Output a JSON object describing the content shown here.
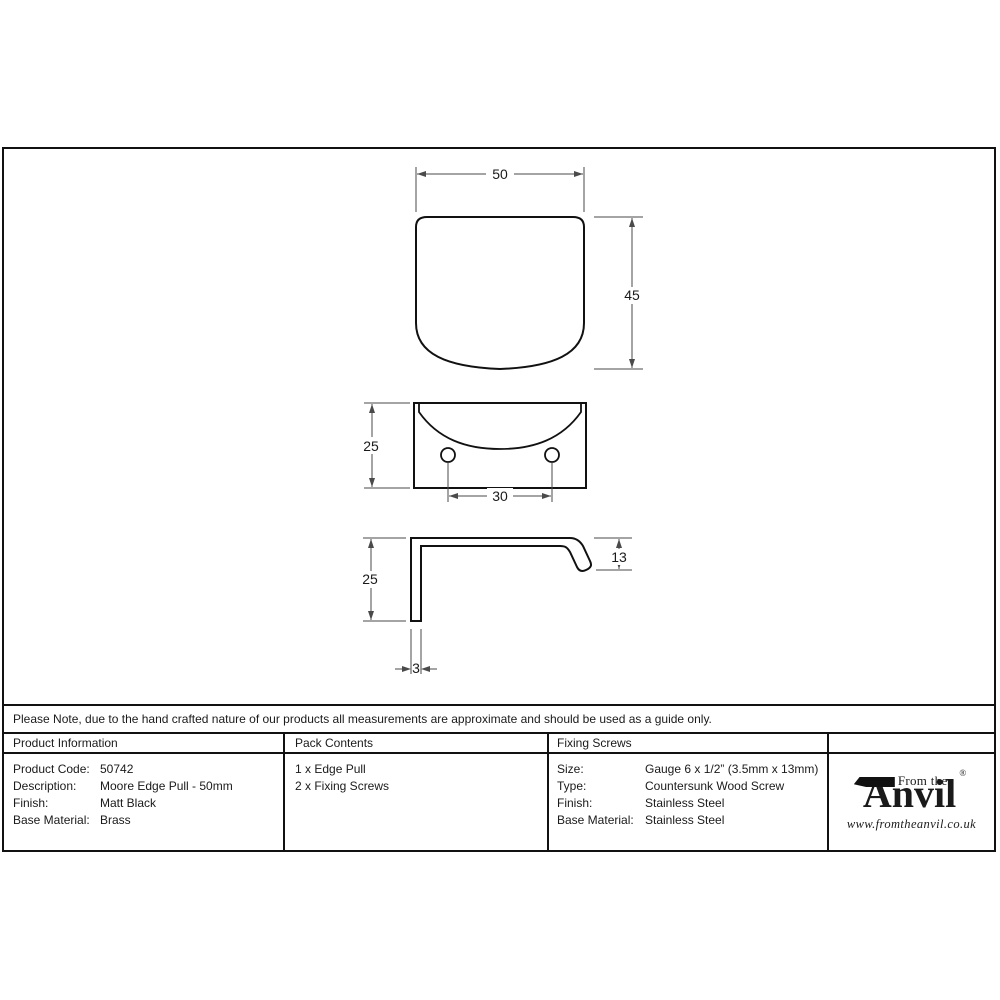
{
  "note": "Please Note, due to the hand crafted nature of our products all measurements are approximate and should be used as a guide only.",
  "drawing": {
    "front": {
      "width": "50",
      "height": "45"
    },
    "plan": {
      "depth": "25",
      "hole_spacing": "30"
    },
    "profile": {
      "height": "25",
      "lip": "13",
      "thickness": "3"
    }
  },
  "table": {
    "product_info": {
      "header": "Product Information",
      "rows": [
        {
          "label": "Product Code:",
          "value": "50742"
        },
        {
          "label": "Description:",
          "value": "Moore Edge Pull - 50mm"
        },
        {
          "label": "Finish:",
          "value": "Matt Black"
        },
        {
          "label": "Base Material:",
          "value": "Brass"
        }
      ]
    },
    "pack_contents": {
      "header": "Pack Contents",
      "lines": [
        "1 x Edge Pull",
        "2 x Fixing Screws"
      ]
    },
    "fixing_screws": {
      "header": "Fixing Screws",
      "rows": [
        {
          "label": "Size:",
          "value": "Gauge 6 x 1/2” (3.5mm x 13mm)"
        },
        {
          "label": "Type:",
          "value": "Countersunk Wood Screw"
        },
        {
          "label": "Finish:",
          "value": "Stainless Steel"
        },
        {
          "label": "Base Material:",
          "value": "Stainless Steel"
        }
      ]
    }
  },
  "logo": {
    "from_the": "From the",
    "name_initial": "A",
    "name_rest": "nvil",
    "registered": "®",
    "website": "www.fromtheanvil.co.uk"
  },
  "colors": {
    "line": "#111111",
    "dim_line": "#4a4a4a"
  }
}
